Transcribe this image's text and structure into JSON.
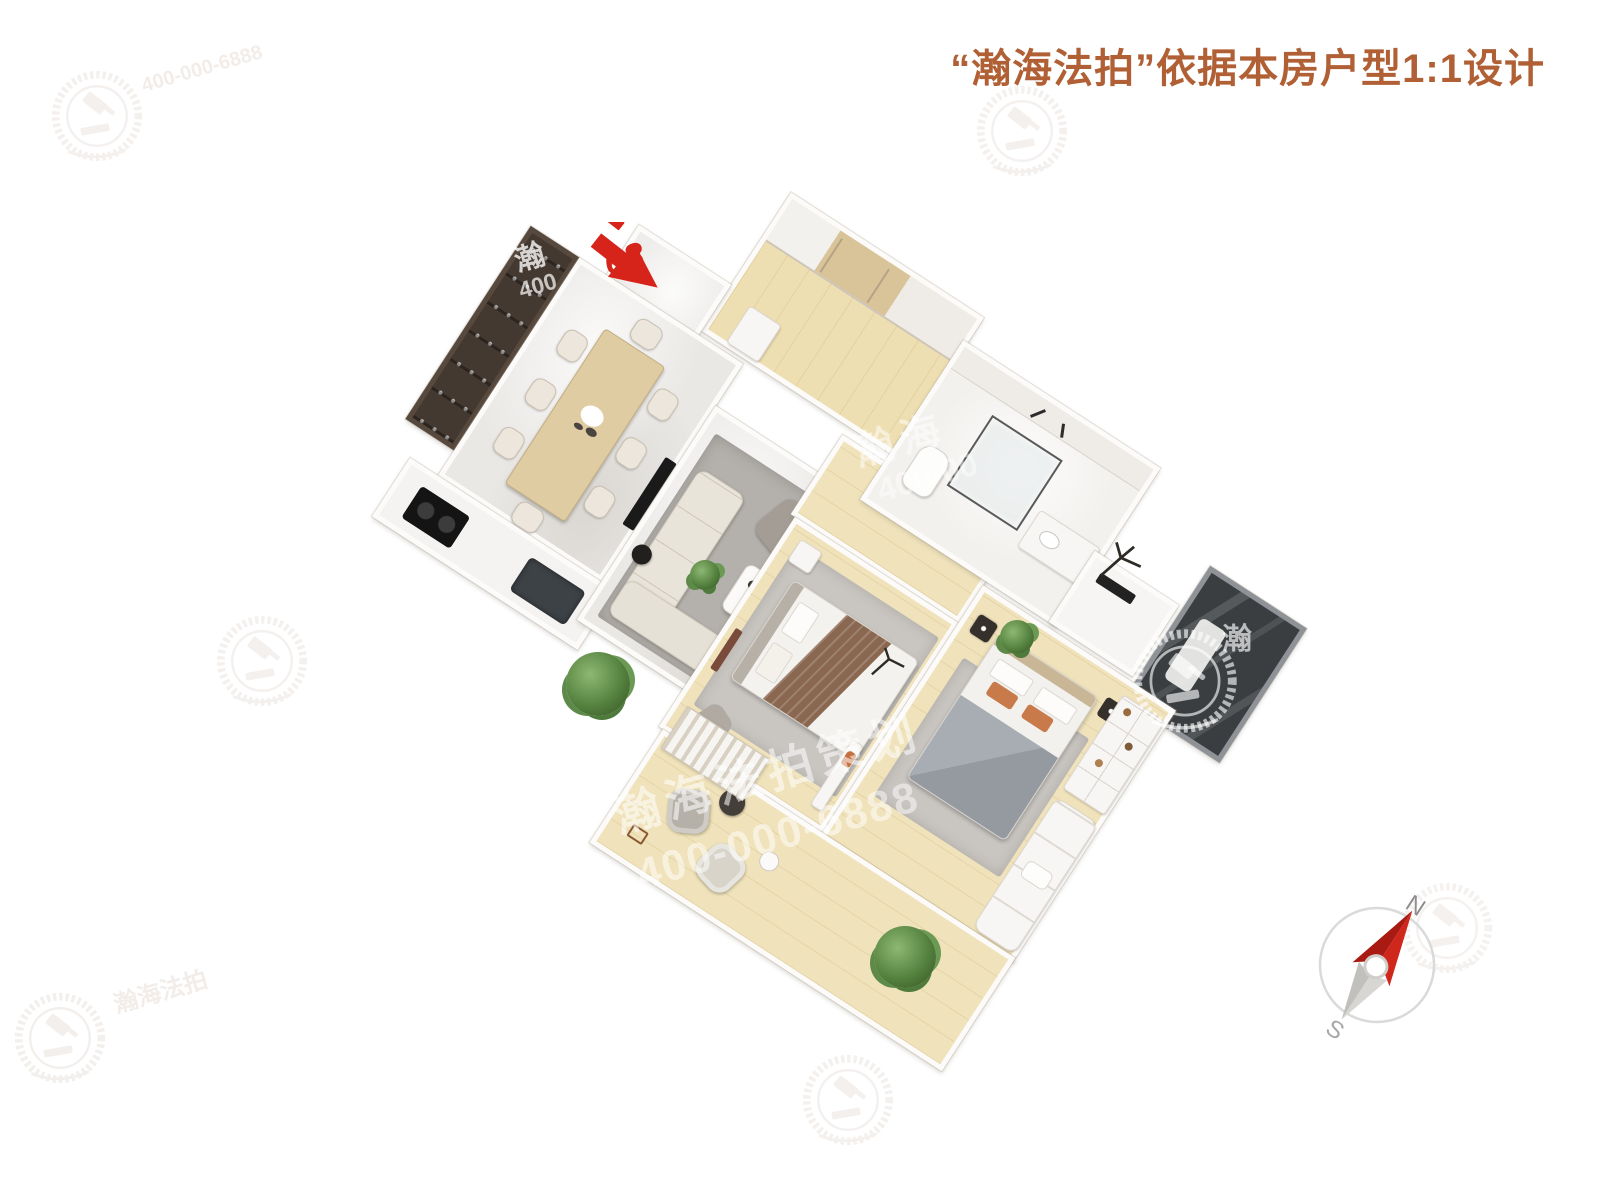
{
  "header": {
    "title": "“瀚海法拍”依据本房户型1:1设计",
    "title_color": "#b06034"
  },
  "entry": {
    "digits": "68",
    "arrow_color": "#d6241b"
  },
  "watermarks": {
    "main_brand": "瀚海法拍策划",
    "main_phone": "400-000-6888",
    "bath_brand": "瀚海",
    "bath_phone": "400-00",
    "cabinet_char": "瀚",
    "cabinet_phone": "400",
    "balcony_char": "瀚",
    "ghost_phone": "400-000-6888",
    "ghost_brand": "瀚海法拍"
  },
  "compass": {
    "north": "N",
    "south": "S",
    "needle_color": "#d0271d"
  },
  "palette": {
    "wood_floor": "#f0e3bb",
    "marble_floor": "#eae8e5",
    "dark_cabinet": "#443930",
    "dark_balcony": "#3a3e41",
    "living_rug": "#b4b0ac",
    "bedroom_rug": "#c9c5c1",
    "emblem_faint": "#f4f0ee"
  }
}
